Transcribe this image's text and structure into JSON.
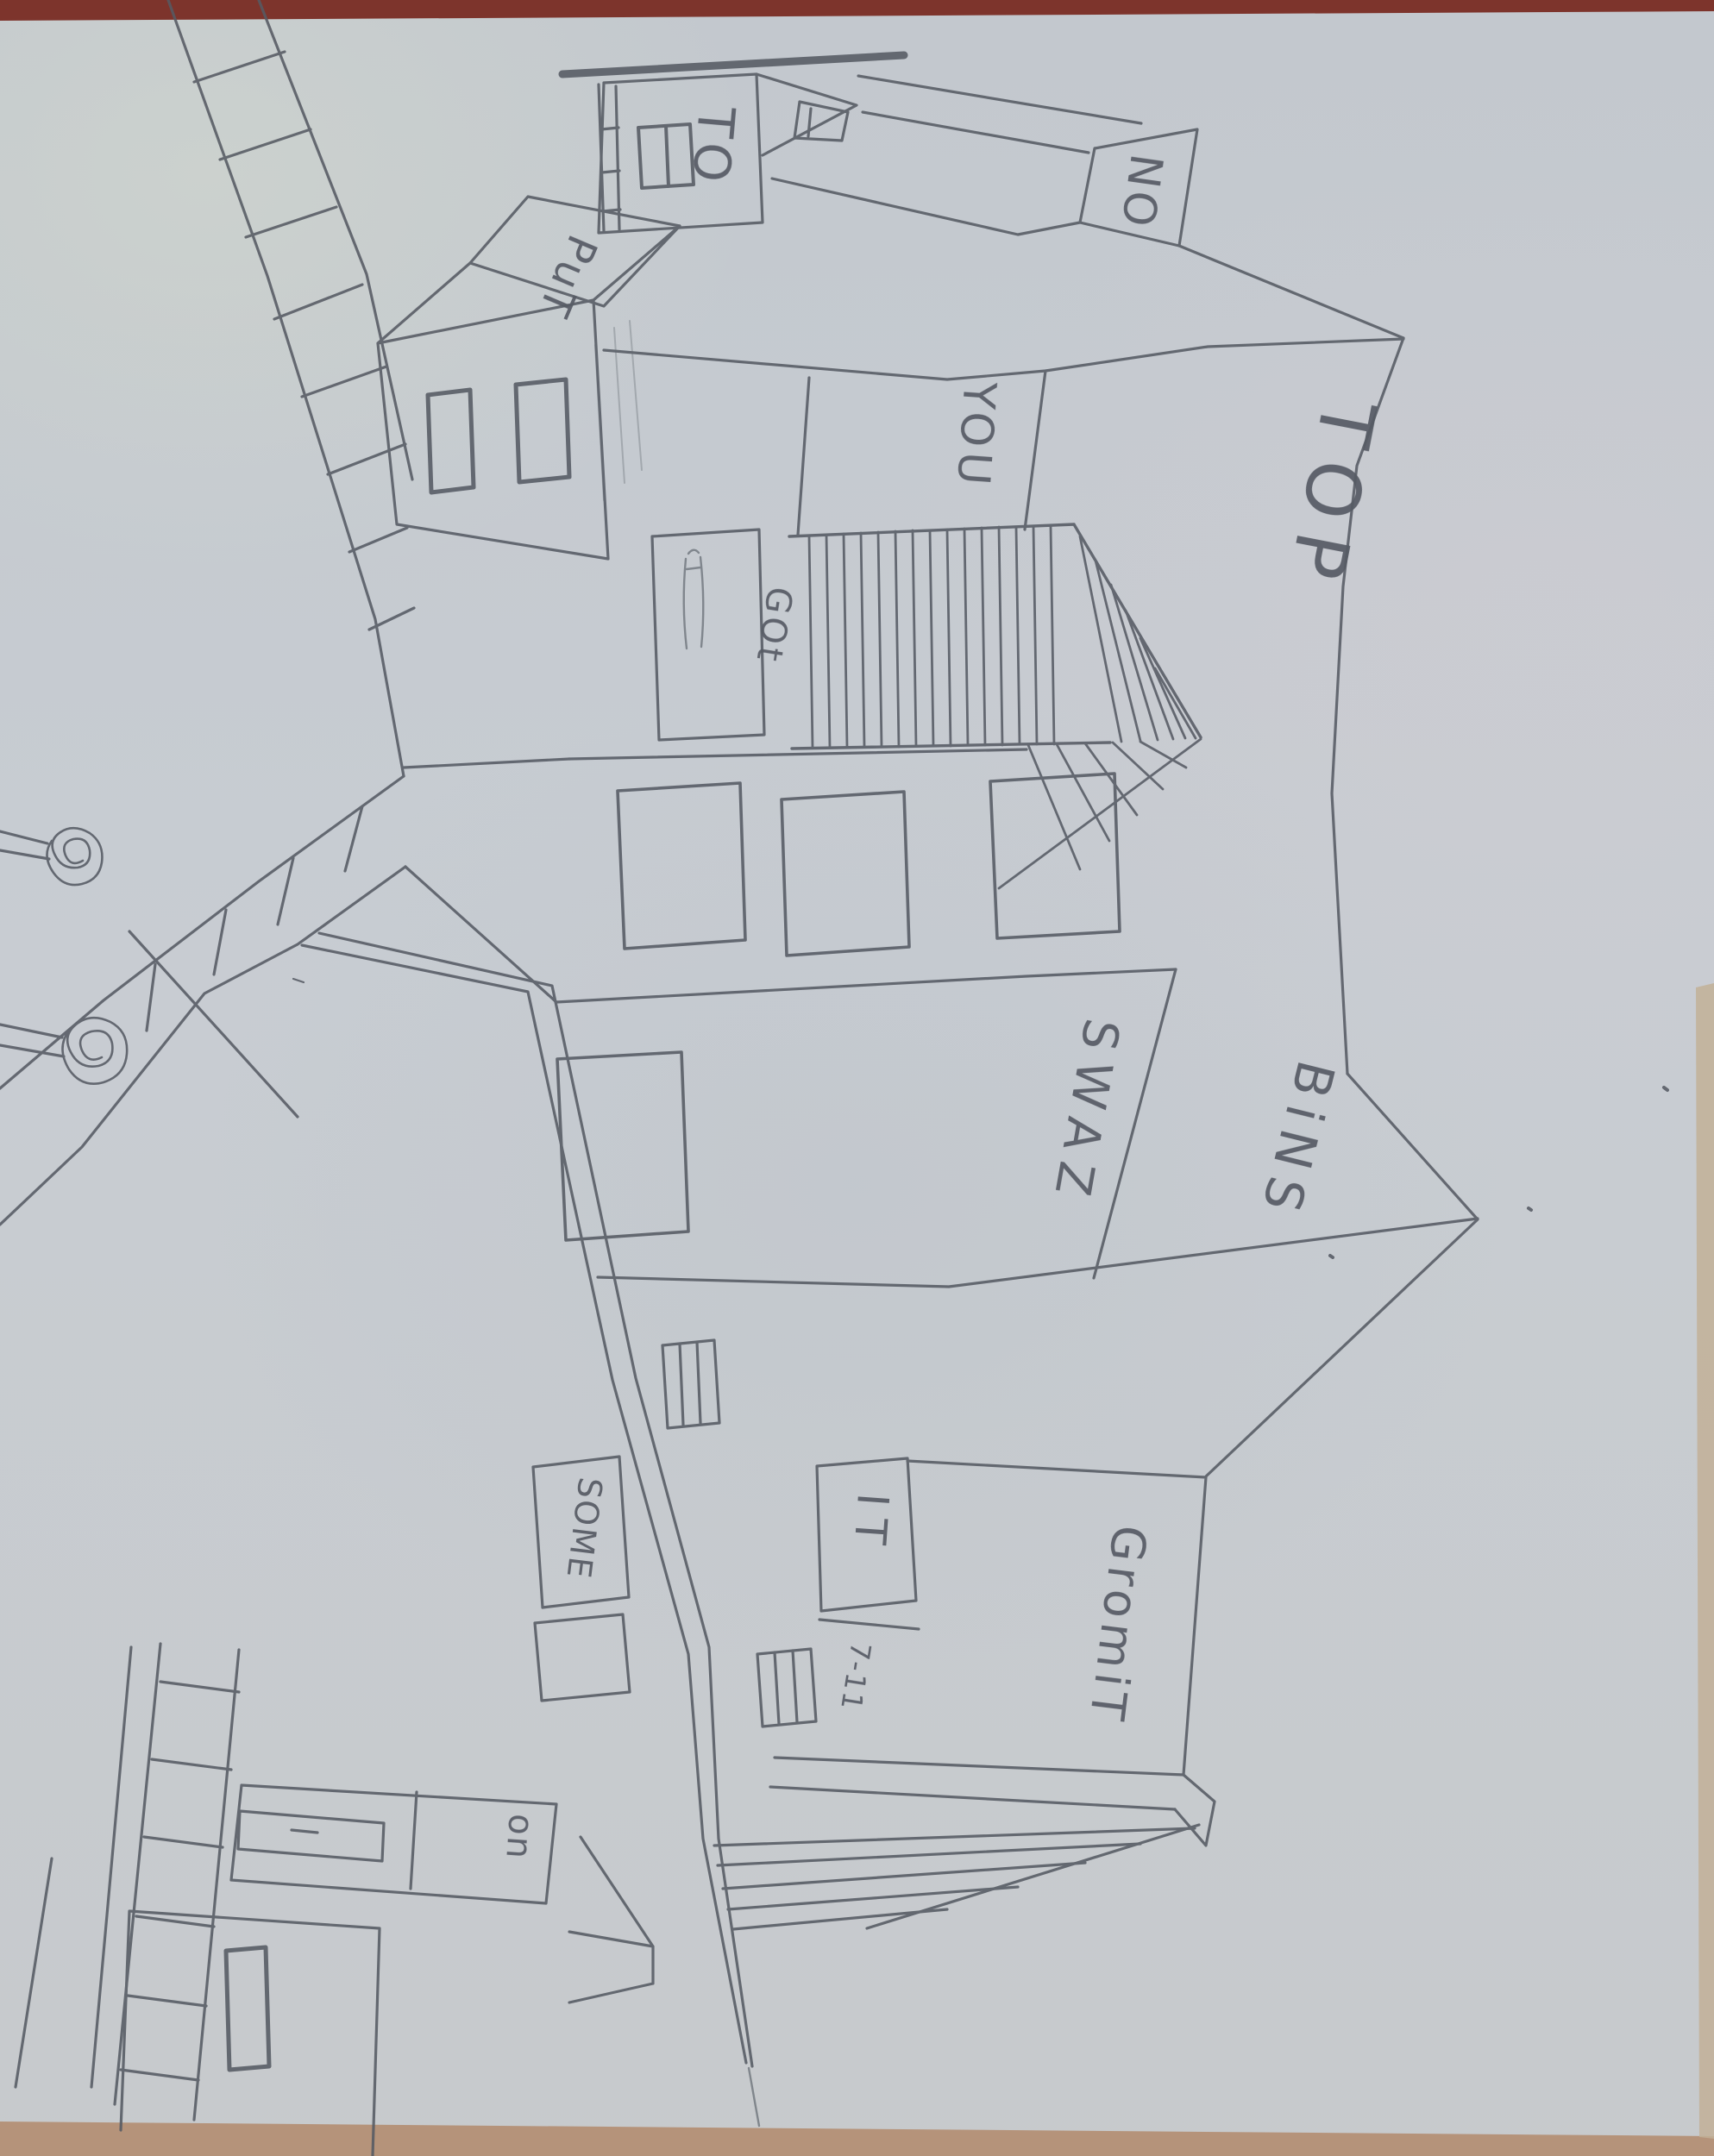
{
  "scene": {
    "description_labels_note": "hand-drawn one-point-perspective street sketch photographed sideways",
    "signs": {
      "to": "TO",
      "put": "PuT",
      "no": "NO",
      "you": "YOU",
      "got": "GOt",
      "top": "TOP",
      "swaz": "SWAZ",
      "bins": "BiNS",
      "some": "SOME",
      "it": "IT",
      "seven_eleven": "7-11",
      "gromit": "GromiT",
      "on": "on"
    },
    "colors": {
      "paper": "#c7ccd2",
      "pencil": "#565b64",
      "table_top": "#7d342c",
      "table_bottom": "#b5937a",
      "paper_edge_right": "#c2b098"
    }
  }
}
